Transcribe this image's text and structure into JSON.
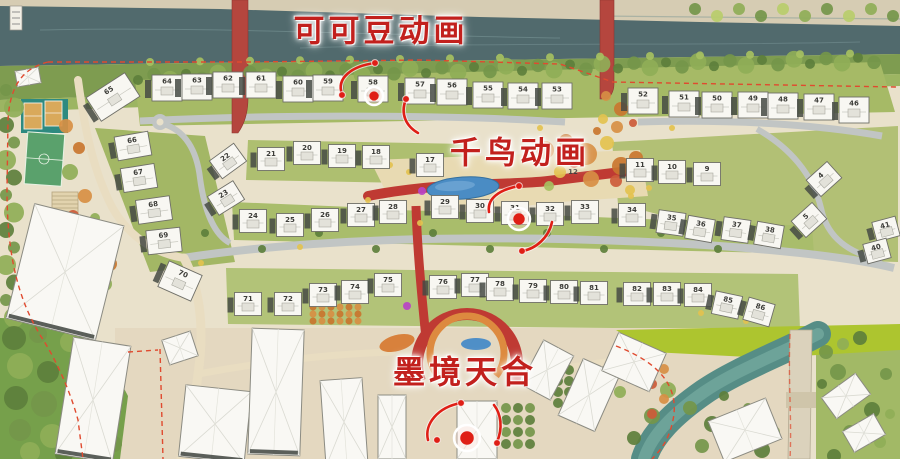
{
  "annotations": {
    "label_red": "#c2201d",
    "accent_red": "#df1f16",
    "labels": [
      {
        "text": "可可豆动画",
        "x": 381,
        "y": 28,
        "size": 31
      },
      {
        "text": "千鸟动画",
        "x": 520,
        "y": 150,
        "size": 31
      },
      {
        "text": "墨境天合",
        "x": 465,
        "y": 370,
        "size": 32
      }
    ],
    "targets": [
      {
        "x": 374,
        "y": 96,
        "r": 9
      },
      {
        "x": 519,
        "y": 219,
        "r": 11
      },
      {
        "x": 467,
        "y": 438,
        "r": 13
      }
    ],
    "dots": [
      [
        375,
        63
      ],
      [
        342,
        95
      ],
      [
        406,
        99
      ],
      [
        519,
        186
      ],
      [
        522,
        251
      ],
      [
        461,
        403
      ],
      [
        437,
        440
      ],
      [
        497,
        443
      ]
    ],
    "arrows": [
      "M375,63 C352,66 336,78 342,94",
      "M406,99 C400,114 406,126 418,133",
      "M519,186 C498,190 487,199 489,212",
      "M522,251 C536,249 549,237 552,222",
      "M461,403 C438,407 424,424 428,440",
      "M497,442 C503,428 501,414 494,405"
    ]
  },
  "buildings": [
    {
      "n": "65",
      "x": 113,
      "y": 97,
      "w": 46,
      "h": 28,
      "r": -33
    },
    {
      "n": "64",
      "x": 167,
      "y": 88,
      "w": 30,
      "h": 26
    },
    {
      "n": "63",
      "x": 197,
      "y": 87,
      "w": 30,
      "h": 26
    },
    {
      "n": "62",
      "x": 228,
      "y": 85,
      "w": 30,
      "h": 26
    },
    {
      "n": "61",
      "x": 261,
      "y": 85,
      "w": 30,
      "h": 26
    },
    {
      "n": "60",
      "x": 298,
      "y": 89,
      "w": 30,
      "h": 26
    },
    {
      "n": "59",
      "x": 328,
      "y": 88,
      "w": 30,
      "h": 26
    },
    {
      "n": "58",
      "x": 373,
      "y": 89,
      "w": 30,
      "h": 26
    },
    {
      "n": "57",
      "x": 420,
      "y": 91,
      "w": 30,
      "h": 26
    },
    {
      "n": "56",
      "x": 452,
      "y": 92,
      "w": 30,
      "h": 26
    },
    {
      "n": "55",
      "x": 488,
      "y": 95,
      "w": 30,
      "h": 26
    },
    {
      "n": "54",
      "x": 523,
      "y": 96,
      "w": 30,
      "h": 26
    },
    {
      "n": "53",
      "x": 557,
      "y": 96,
      "w": 30,
      "h": 26
    },
    {
      "n": "52",
      "x": 643,
      "y": 101,
      "w": 30,
      "h": 26
    },
    {
      "n": "51",
      "x": 684,
      "y": 104,
      "w": 30,
      "h": 26
    },
    {
      "n": "50",
      "x": 717,
      "y": 105,
      "w": 30,
      "h": 26
    },
    {
      "n": "49",
      "x": 753,
      "y": 105,
      "w": 30,
      "h": 26
    },
    {
      "n": "48",
      "x": 783,
      "y": 106,
      "w": 30,
      "h": 26
    },
    {
      "n": "47",
      "x": 819,
      "y": 107,
      "w": 30,
      "h": 26
    },
    {
      "n": "46",
      "x": 854,
      "y": 110,
      "w": 30,
      "h": 26
    },
    {
      "n": "66",
      "x": 133,
      "y": 146,
      "w": 34,
      "h": 24,
      "r": -10
    },
    {
      "n": "67",
      "x": 139,
      "y": 178,
      "w": 34,
      "h": 24,
      "r": -9
    },
    {
      "n": "68",
      "x": 154,
      "y": 210,
      "w": 34,
      "h": 24,
      "r": -8
    },
    {
      "n": "69",
      "x": 164,
      "y": 241,
      "w": 34,
      "h": 24,
      "r": -6
    },
    {
      "n": "70",
      "x": 180,
      "y": 281,
      "w": 36,
      "h": 28,
      "r": 24
    },
    {
      "n": "22",
      "x": 228,
      "y": 161,
      "w": 30,
      "h": 22,
      "r": -36
    },
    {
      "n": "23",
      "x": 226,
      "y": 198,
      "w": 30,
      "h": 22,
      "r": -32
    },
    {
      "n": "21",
      "x": 271,
      "y": 159
    },
    {
      "n": "20",
      "x": 307,
      "y": 153
    },
    {
      "n": "19",
      "x": 342,
      "y": 156
    },
    {
      "n": "18",
      "x": 376,
      "y": 157
    },
    {
      "n": "17",
      "x": 430,
      "y": 165
    },
    {
      "n": "12",
      "x": 573,
      "y": 171,
      "t": 1
    },
    {
      "n": "11",
      "x": 640,
      "y": 170
    },
    {
      "n": "10",
      "x": 672,
      "y": 172
    },
    {
      "n": "9",
      "x": 707,
      "y": 174
    },
    {
      "n": "4",
      "x": 824,
      "y": 179,
      "w": 28,
      "h": 22,
      "r": -42
    },
    {
      "n": "5",
      "x": 809,
      "y": 220,
      "w": 28,
      "h": 22,
      "r": -42
    },
    {
      "n": "41",
      "x": 886,
      "y": 229,
      "w": 24,
      "h": 20,
      "r": -15
    },
    {
      "n": "40",
      "x": 877,
      "y": 251,
      "w": 24,
      "h": 20,
      "r": -15
    },
    {
      "n": "24",
      "x": 253,
      "y": 221
    },
    {
      "n": "25",
      "x": 290,
      "y": 225
    },
    {
      "n": "26",
      "x": 325,
      "y": 220
    },
    {
      "n": "27",
      "x": 361,
      "y": 215
    },
    {
      "n": "28",
      "x": 393,
      "y": 212
    },
    {
      "n": "29",
      "x": 445,
      "y": 207
    },
    {
      "n": "30",
      "x": 480,
      "y": 211
    },
    {
      "n": "31",
      "x": 515,
      "y": 213
    },
    {
      "n": "32",
      "x": 550,
      "y": 214
    },
    {
      "n": "33",
      "x": 585,
      "y": 212
    },
    {
      "n": "34",
      "x": 632,
      "y": 215
    },
    {
      "n": "35",
      "x": 671,
      "y": 223,
      "r": 8
    },
    {
      "n": "36",
      "x": 700,
      "y": 229,
      "r": 10
    },
    {
      "n": "37",
      "x": 736,
      "y": 230,
      "r": 8
    },
    {
      "n": "38",
      "x": 769,
      "y": 235,
      "r": 10
    },
    {
      "n": "71",
      "x": 248,
      "y": 304
    },
    {
      "n": "72",
      "x": 288,
      "y": 304
    },
    {
      "n": "73",
      "x": 323,
      "y": 295
    },
    {
      "n": "74",
      "x": 355,
      "y": 292
    },
    {
      "n": "75",
      "x": 388,
      "y": 285
    },
    {
      "n": "76",
      "x": 443,
      "y": 287
    },
    {
      "n": "77",
      "x": 475,
      "y": 285
    },
    {
      "n": "78",
      "x": 500,
      "y": 289
    },
    {
      "n": "79",
      "x": 533,
      "y": 291
    },
    {
      "n": "80",
      "x": 564,
      "y": 292
    },
    {
      "n": "81",
      "x": 594,
      "y": 293
    },
    {
      "n": "82",
      "x": 637,
      "y": 294
    },
    {
      "n": "83",
      "x": 667,
      "y": 294
    },
    {
      "n": "84",
      "x": 698,
      "y": 295
    },
    {
      "n": "85",
      "x": 727,
      "y": 305,
      "r": 12
    },
    {
      "n": "86",
      "x": 759,
      "y": 312,
      "r": 16
    }
  ]
}
